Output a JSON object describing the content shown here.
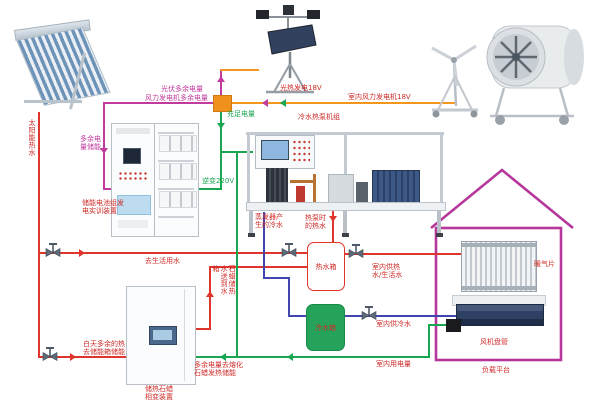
{
  "colors": {
    "red": "#de352c",
    "blue": "#4345af",
    "green": "#18a653",
    "magenta": "#c13a9e",
    "orange": "#f2961d",
    "house": "#b6379b",
    "label": "#ce2b28"
  },
  "labels": {
    "solar_hot_water": "太阳能热水",
    "pv_surplus": "光伏多余电量",
    "wind_surplus": "风力发电机多余电量",
    "surplus_to_storage": "多余电量储能",
    "battery_system": "储能电池组发电实训装置",
    "charge_enough": "充足电量",
    "inverter_220v": "逆变220V",
    "pv_gen_18v": "光热发电18V",
    "indoor_wind_18v": "室内风力发电机18V",
    "chiller_heat_pump": "冷水热泵机组",
    "evaporator_cold_water": "蒸发器产生的冷水",
    "heat_pump_hot_water": "热泵时的热水",
    "to_domestic_water": "去生活用水",
    "hot_water_tank": "热水箱",
    "cold_water_tank": "冷水箱",
    "indoor_hot_water": "室内供热水/生活水",
    "indoor_cold_water": "室内供冷水",
    "indoor_power": "室内用电量",
    "paraffin_water_to_tank": "石蜡储热水送到水箱",
    "day_surplus_heat": "白天多余的热去储能箱储能",
    "surplus_melt_paraffin": "多余电量去熔化石蜡发热储能",
    "pcm_device": "储热石蜡相变装置",
    "radiator": "暖气片",
    "fan_coil": "风机盘管",
    "load_platform": "负载平台"
  }
}
